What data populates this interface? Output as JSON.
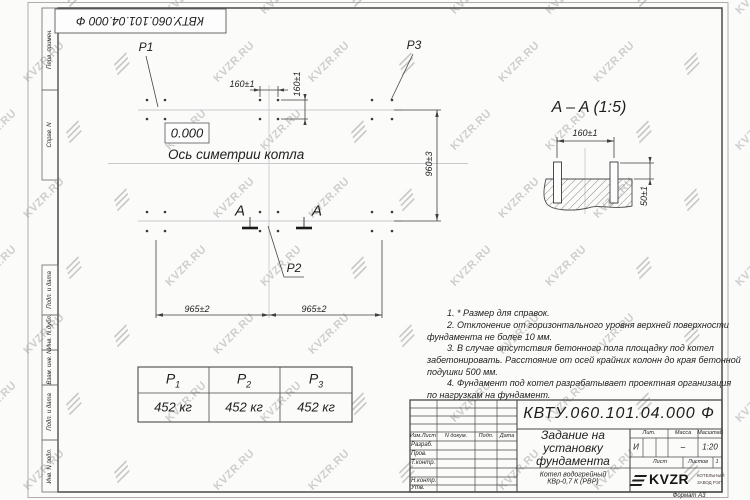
{
  "watermark": {
    "text": "KVZR.RU"
  },
  "frame": {
    "top_designation": "КВТУ.060.101.04.000  Ф",
    "left_labels": [
      "Перв. примен.",
      "Справ. N",
      "Подп. и дата",
      "Инв. N дубл.",
      "Взам. инв. N",
      "Подп. и дата",
      "Инв. N подл."
    ]
  },
  "plan": {
    "p1": "P1",
    "p2": "P2",
    "p3": "P3",
    "elevation": "0.000",
    "axis_label": "Ось симетрии котла",
    "section_letter_left": "A",
    "section_letter_right": "A",
    "dim_160_top": "160±1",
    "dim_160_side": "160±1",
    "dim_960": "960±3",
    "dim_965_left": "965±2",
    "dim_965_right": "965±2"
  },
  "section": {
    "title": "A – A (1:5)",
    "dim_160": "160±1",
    "dim_50": "50±1"
  },
  "load_table": {
    "columns": [
      {
        "label": "P",
        "sub": "1",
        "value": "452 кг"
      },
      {
        "label": "P",
        "sub": "2",
        "value": "452 кг"
      },
      {
        "label": "P",
        "sub": "3",
        "value": "452 кг"
      }
    ]
  },
  "notes": {
    "lines": [
      "1. * Размер для справок.",
      "2. Отклонение от горизонтального уровня верхней поверхности",
      "фундамента не более 10 мм.",
      "3. В случае отсутствия бетонного пола площадку под котел",
      "забетонировать. Расстояние от осей крайних колонн до края бетонной",
      "подушки 500 мм.",
      "4. Фундамент под котел разрабатывает проектная организация",
      "по нагрузкам на фундамент."
    ]
  },
  "title_block": {
    "designation": "КВТУ.060.101.04.000  Ф",
    "title_lines": [
      "Задание на",
      "установку",
      "фундамента"
    ],
    "product_lines": [
      "Котел водогрейный",
      "КВр-0,7 К (РВР)"
    ],
    "header_cols": [
      "Изм.Лист",
      "N докум.",
      "Подп.",
      "Дата"
    ],
    "row_labels": [
      "Разраб.",
      "Пров.",
      "Т.контр.",
      "Н.контр.",
      "Утв."
    ],
    "lit_label": "Лит.",
    "mass_label": "Масса",
    "scale_label": "Масштаб",
    "lit_value": "И",
    "mass_value": "–",
    "scale_value": "1:20",
    "sheet_label": "Лист",
    "sheets_label": "Листов",
    "sheets_value": "1",
    "logo_text": "KVZR",
    "logo_sub1": "КОТЕЛЬНЫЙ",
    "logo_sub2": "ЗАВОД РЭП",
    "format": "Формат А3"
  }
}
